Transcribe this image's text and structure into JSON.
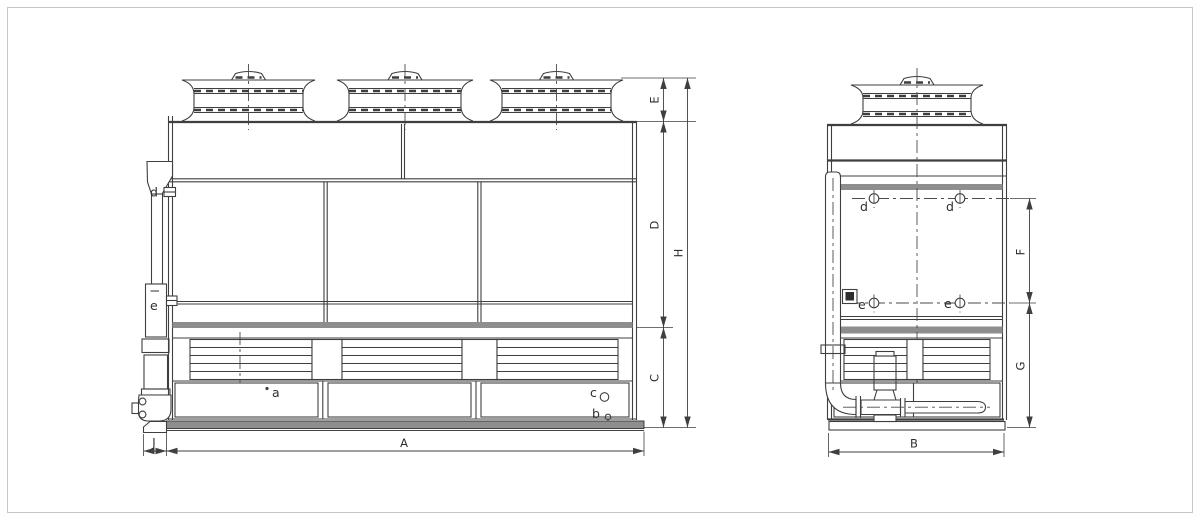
{
  "drawing": {
    "type": "two-view engineering drawing of a closed-circuit cooling tower",
    "views": [
      {
        "name": "front-view",
        "fan_cowls": 3
      },
      {
        "name": "side-view",
        "fan_cowls": 1
      }
    ],
    "colors": {
      "line": "#3f3f3f",
      "gray_band": "#8e8e8e",
      "background": "#ffffff",
      "frame_border": "#c6c6c6",
      "text": "#2e2e2e"
    }
  },
  "labels": {
    "dims": {
      "E": "E",
      "D": "D",
      "H": "H",
      "C": "C",
      "A": "A",
      "J": "J",
      "F": "F",
      "G": "G",
      "B": "B"
    },
    "ports": {
      "a": "a",
      "b": "b",
      "c": "c",
      "d": "d",
      "e": "e"
    }
  }
}
